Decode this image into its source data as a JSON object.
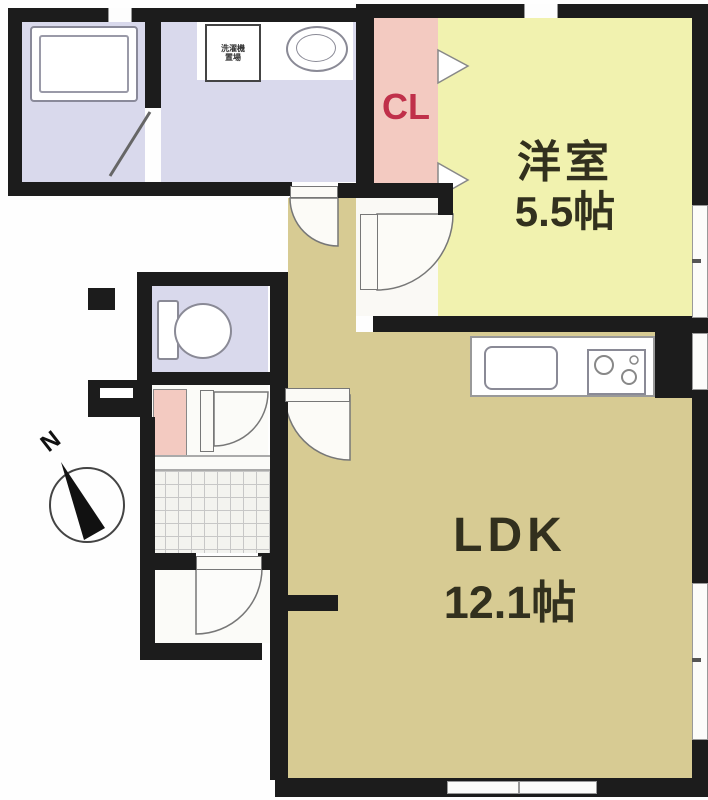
{
  "title": "1LDK apartment floor plan",
  "compass": {
    "north_label": "N"
  },
  "rooms": {
    "western": {
      "name": "洋室",
      "size": "5.5帖"
    },
    "ldk": {
      "name": "LDK",
      "size": "12.1帖"
    },
    "closet": {
      "label": "CL"
    },
    "washer": {
      "line1": "洗濯機",
      "line2": "置場"
    }
  },
  "colors": {
    "wall": "#1c1c1c",
    "ldk": "#d7cb93",
    "western": "#f1f2af",
    "lavender": "#d9d9ec",
    "pink": "#f3cac1",
    "accent_red": "#c0304a",
    "tile": "#f3f3ef",
    "door": "#fbfaf6"
  }
}
